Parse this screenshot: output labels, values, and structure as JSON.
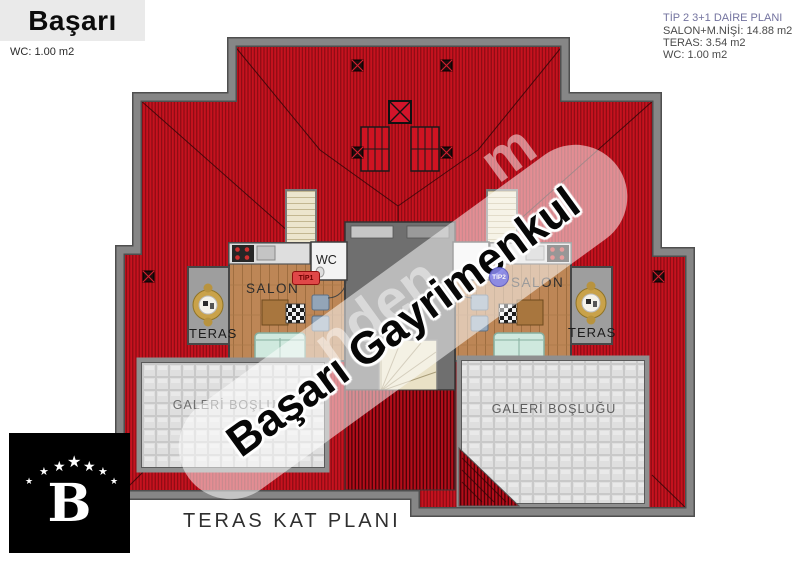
{
  "header": {
    "brand": "Başarı",
    "left_note": "WC: 1.00 m2",
    "plan_info": {
      "title": "TİP 2 3+1 DAİRE PLANI",
      "line1": "SALON+M.NİŞİ: 14.88 m2",
      "line2": "TERAS: 3.54 m2",
      "line3": "WC: 1.00 m2"
    }
  },
  "plan": {
    "labels": {
      "salon_left": "SALON",
      "salon_right": "SALON",
      "wc_left": "WC",
      "teras_left": "TERAS",
      "teras_right": "TERAS",
      "gallery_left": "GALERİ BOŞLUĞU",
      "gallery_right": "GALERİ BOŞLUĞU",
      "badge_tip1": "TİP1",
      "badge_tip2": "TİP2"
    },
    "colors": {
      "roof_red": "#c6121f",
      "roof_hatch": "#850a12",
      "wall_gray": "#868686",
      "tile_gray": "#dfdfdf",
      "wood": "#bd8656",
      "core_gray": "#6f6f6f",
      "badge1_red": "#e04848",
      "badge2_purple": "#8585e8",
      "info_title_purple": "#73739f"
    }
  },
  "watermark": {
    "text": "Başarı Gayrimenkul",
    "faint_fragment_1": "nden",
    "faint_fragment_2": "m"
  },
  "footer": {
    "logo_letter": "B",
    "star_glyph": "★",
    "caption": "TERAS KAT PLANI"
  }
}
